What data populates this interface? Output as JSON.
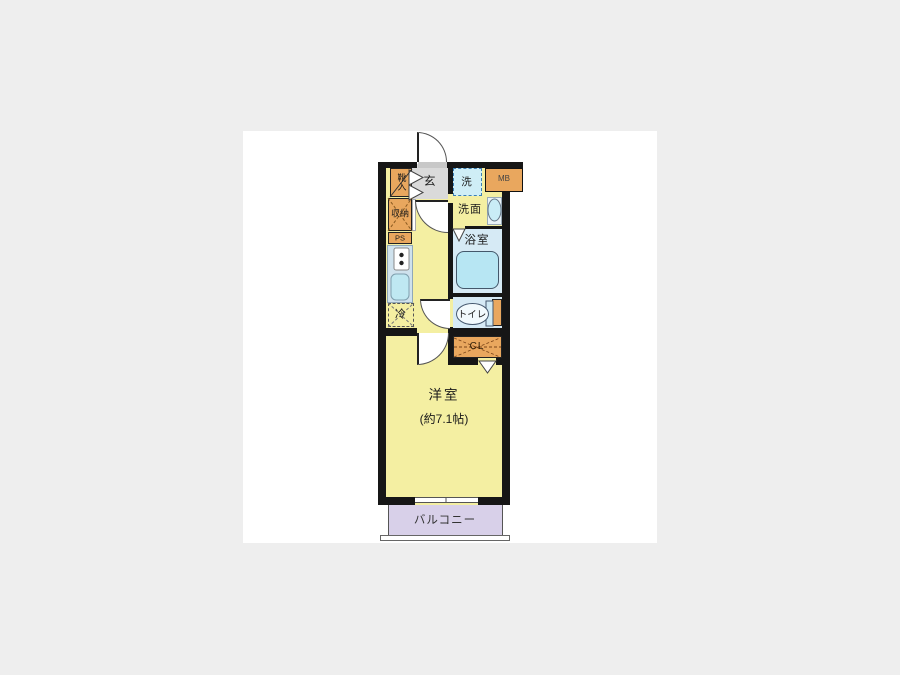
{
  "plan": {
    "rooms": {
      "genkan": {
        "label": "玄"
      },
      "washer": {
        "label": "洗"
      },
      "meter_box": {
        "label": "MB"
      },
      "shoe_box": {
        "label": "靴入"
      },
      "storage": {
        "label": "収納"
      },
      "pipe_space": {
        "label": "PS"
      },
      "washroom": {
        "label": "洗面"
      },
      "bathroom": {
        "label": "浴室"
      },
      "fridge": {
        "label": "冷"
      },
      "toilet": {
        "label": "トイレ"
      },
      "closet": {
        "label": "CL"
      },
      "western_room": {
        "label": "洋室",
        "size": "(約7.1帖)"
      },
      "balcony": {
        "label": "バルコニー"
      }
    },
    "colors": {
      "floor_yellow": "#f4efa2",
      "cabinet_orange": "#e9a75e",
      "wet_blue": "#d6eaf5",
      "tub_cyan": "#b7e6f3",
      "balcony_lavender": "#d8d0e9",
      "wall_black": "#161616",
      "page_bg": "#eeeeee"
    }
  }
}
